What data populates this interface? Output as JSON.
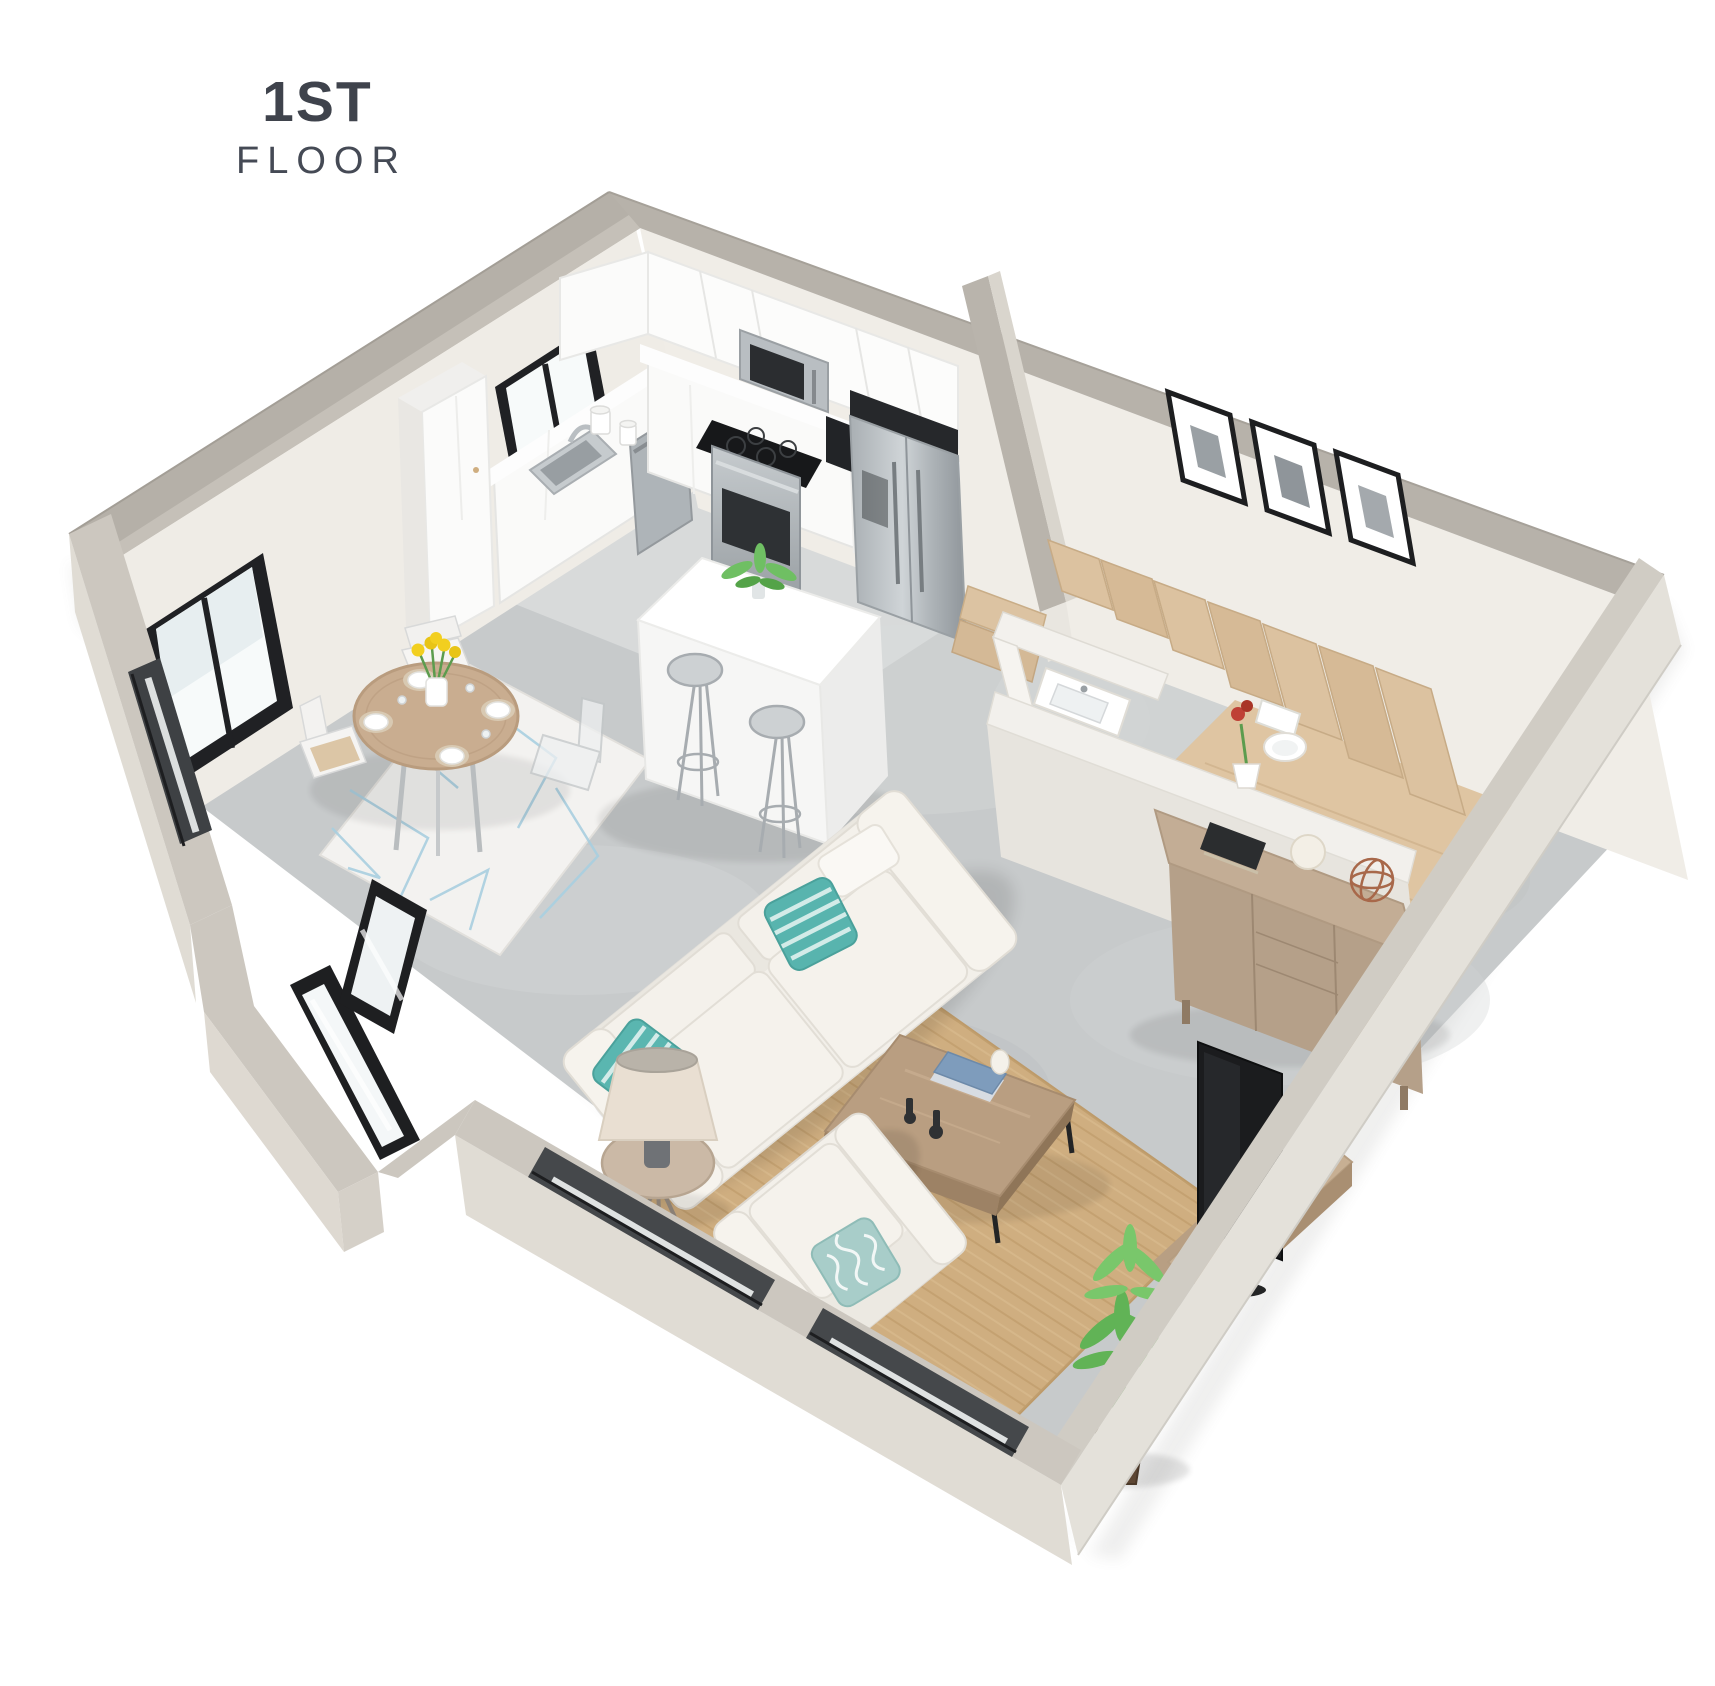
{
  "title": {
    "floor_number": "1ST",
    "floor_label": "FLOOR"
  },
  "palette": {
    "background": "#ffffff",
    "wall_top_far": "#b5b0a8",
    "wall_top_near": "#cbc6be",
    "wall_interior_face": "#efece6",
    "wall_exterior_face": "#e0dcd4",
    "floor_concrete": "#c7cacb",
    "floor_kitchen": "#d9dbdc",
    "wood_stairs": "#dcc2a0",
    "wood_landing": "#dfc5a2",
    "wood_dresser": "#c3ad95",
    "wood_coffee_table": "#b99e81",
    "wood_console": "#c7af93",
    "rug_jute": "#cfae80",
    "rug_dining": "#f3f2f0",
    "rug_dining_pattern": "#a9cfe0",
    "sofa_fabric": "#f2efe9",
    "pillow_teal": "#58b4ae",
    "cabinet_white": "#fbfbfa",
    "stainless_steel": "#b6bbbf",
    "window_frame_black": "#1d1e20",
    "plant_green": "#5cad53",
    "tulip_yellow": "#f2cf1f",
    "flower_red": "#bf4136",
    "title_text": "#3f434c"
  },
  "scene": {
    "view": "3d-isometric-floor-plan",
    "areas": [
      {
        "name": "kitchen",
        "items": [
          "upper-cabinets",
          "microwave",
          "gas-range",
          "refrigerator",
          "coffee-maker",
          "dishwasher",
          "kitchen-sink",
          "pantry-cabinet",
          "kitchen-window",
          "countertop-canisters",
          "kitchen-island",
          "bar-stools",
          "island-plant"
        ],
        "counts": {
          "bar_stools": 2,
          "canisters": 2
        }
      },
      {
        "name": "dining-area",
        "items": [
          "round-dining-table",
          "dining-chairs",
          "tulip-centerpiece",
          "place-settings",
          "geometric-rug",
          "dining-window"
        ],
        "counts": {
          "chairs": 4,
          "place_settings": 4
        }
      },
      {
        "name": "living-room",
        "items": [
          "sofa",
          "striped-accent-pillows",
          "patterned-pillow",
          "armchair",
          "floor-lamp",
          "side-table",
          "coffee-table",
          "coffee-table-books",
          "jute-rug",
          "television",
          "media-console",
          "potted-plant"
        ],
        "counts": {
          "accent_pillows": 2
        }
      },
      {
        "name": "stair-hall",
        "items": [
          "staircase",
          "wood-landing",
          "gallery-wall-frames",
          "sideboard",
          "flower-pot",
          "book",
          "yarn-ball",
          "wire-sphere"
        ],
        "counts": {
          "frames": 3,
          "visible_treads": 7
        }
      },
      {
        "name": "powder-room",
        "items": [
          "vanity-sink",
          "toilet"
        ]
      },
      {
        "name": "entry",
        "items": [
          "glass-entry-door",
          "sidelight-window",
          "sliced-window-openings"
        ],
        "counts": {
          "window_openings": 3
        }
      }
    ]
  }
}
